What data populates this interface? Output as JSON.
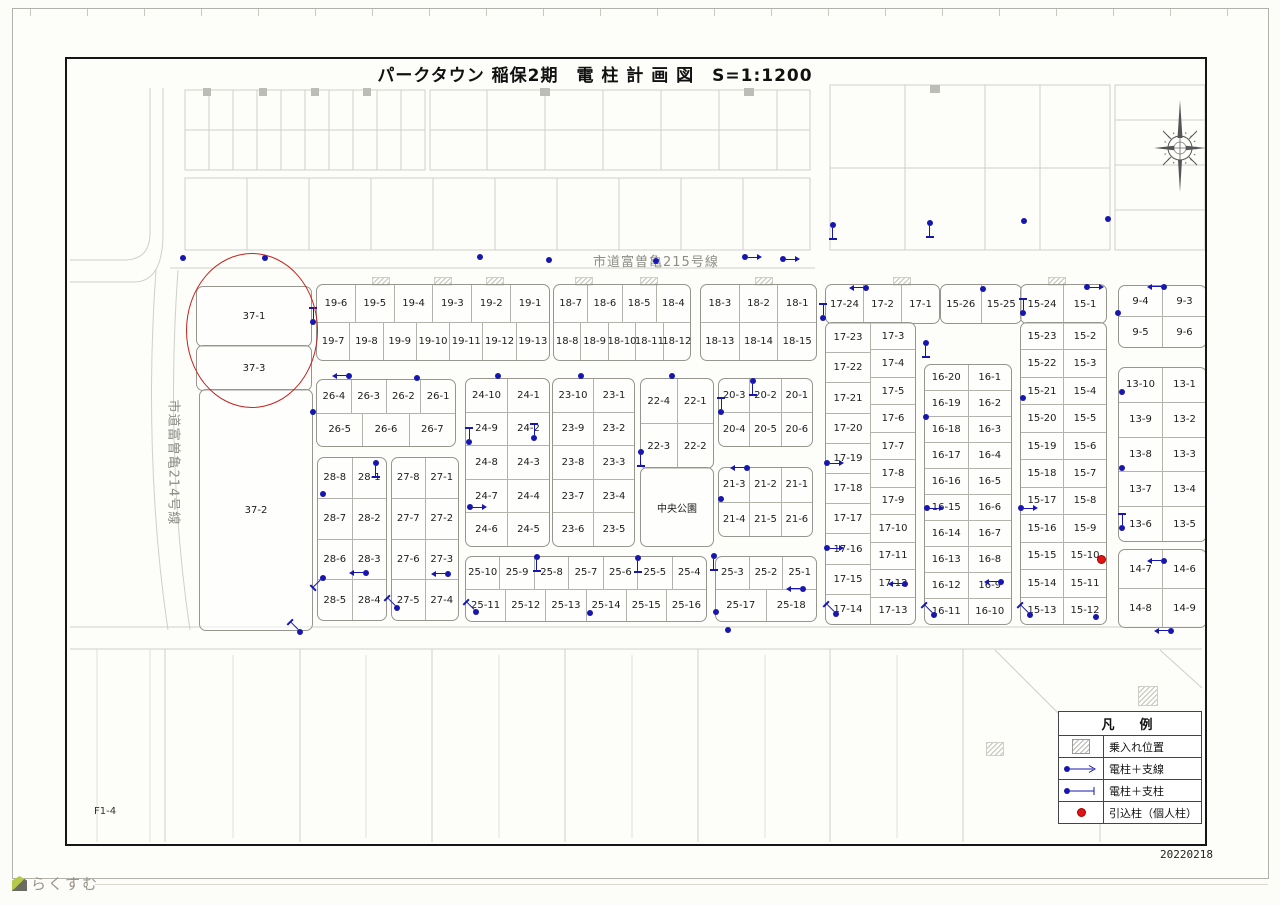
{
  "title": "パークタウン 稲保2期　電 柱 計 画 図　S=1:1200",
  "roads": {
    "r215": "市道富曽亀215号線",
    "r214": "市道富曽亀214号線"
  },
  "sheet_label": "F1-4",
  "date": "20220218",
  "watermark": "らくすむ",
  "legend": {
    "title": "凡　例",
    "items": [
      {
        "symbol": "hatch-square",
        "label": "乗入れ位置"
      },
      {
        "symbol": "pole-arrow",
        "label": "電柱＋支線"
      },
      {
        "symbol": "pole-strut",
        "label": "電柱＋支柱"
      },
      {
        "symbol": "red-dot",
        "label": "引込柱（個人柱）"
      }
    ]
  },
  "colors": {
    "pole_blue": "#1717b0",
    "accent_red": "#c5221c",
    "line_gray": "#cfcfca",
    "frame_black": "#151515"
  },
  "map": {
    "blocks": [
      {
        "id": "19",
        "kind": "rows",
        "x": 316,
        "y": 284,
        "w": 232,
        "h": 75,
        "rows": [
          [
            "19-6",
            "19-5",
            "19-4",
            "19-3",
            "19-2",
            "19-1"
          ],
          [
            "19-7",
            "19-8",
            "19-9",
            "19-10",
            "19-11",
            "19-12",
            "19-13"
          ]
        ]
      },
      {
        "id": "18L",
        "kind": "rows",
        "x": 553,
        "y": 284,
        "w": 136,
        "h": 75,
        "rows": [
          [
            "18-7",
            "18-6",
            "18-5",
            "18-4"
          ],
          [
            "18-8",
            "18-9",
            "18-10",
            "18-11",
            "18-12"
          ]
        ]
      },
      {
        "id": "18R",
        "kind": "rows",
        "x": 700,
        "y": 284,
        "w": 115,
        "h": 75,
        "rows": [
          [
            "18-3",
            "18-2",
            "18-1"
          ],
          [
            "18-13",
            "18-14",
            "18-15"
          ]
        ]
      },
      {
        "id": "17T",
        "kind": "rows",
        "x": 825,
        "y": 284,
        "w": 113,
        "h": 38,
        "rows": [
          [
            "17-24",
            "17-2",
            "17-1"
          ]
        ]
      },
      {
        "id": "15T1",
        "kind": "rows",
        "x": 940,
        "y": 284,
        "w": 80,
        "h": 38,
        "rows": [
          [
            "15-26",
            "15-25"
          ]
        ]
      },
      {
        "id": "15T2",
        "kind": "rows",
        "x": 1020,
        "y": 284,
        "w": 85,
        "h": 38,
        "rows": [
          [
            "15-24",
            "15-1"
          ]
        ]
      },
      {
        "id": "17C",
        "kind": "cols",
        "x": 825,
        "y": 322,
        "w": 89,
        "h": 301,
        "cols": [
          [
            "17-23",
            "17-22",
            "17-21",
            "17-20",
            "17-19",
            "17-18",
            "17-17",
            "17-16",
            "17-15",
            "17-14"
          ],
          [
            "17-3",
            "17-4",
            "17-5",
            "17-6",
            "17-7",
            "17-8",
            "17-9",
            "17-10",
            "17-11",
            "17-12",
            "17-13"
          ]
        ]
      },
      {
        "id": "16",
        "kind": "cols",
        "x": 924,
        "y": 364,
        "w": 86,
        "h": 259,
        "cols": [
          [
            "16-20",
            "16-19",
            "16-18",
            "16-17",
            "16-16",
            "16-15",
            "16-14",
            "16-13",
            "16-12",
            "16-11"
          ],
          [
            "16-1",
            "16-2",
            "16-3",
            "16-4",
            "16-5",
            "16-6",
            "16-7",
            "16-8",
            "16-9",
            "16-10"
          ]
        ]
      },
      {
        "id": "15C",
        "kind": "cols",
        "x": 1020,
        "y": 322,
        "w": 85,
        "h": 301,
        "cols": [
          [
            "15-23",
            "15-22",
            "15-21",
            "15-20",
            "15-19",
            "15-18",
            "15-17",
            "15-16",
            "15-15",
            "15-14",
            "15-13"
          ],
          [
            "15-2",
            "15-3",
            "15-4",
            "15-5",
            "15-6",
            "15-7",
            "15-8",
            "15-9",
            "15-10",
            "15-11",
            "15-12"
          ]
        ]
      },
      {
        "id": "9",
        "kind": "rows",
        "x": 1118,
        "y": 285,
        "w": 87,
        "h": 61,
        "rows": [
          [
            "9-4",
            "9-3"
          ],
          [
            "9-5",
            "9-6"
          ]
        ]
      },
      {
        "id": "13",
        "kind": "cols",
        "x": 1118,
        "y": 367,
        "w": 87,
        "h": 173,
        "cols": [
          [
            "13-10",
            "13-9",
            "13-8",
            "13-7",
            "13-6"
          ],
          [
            "13-1",
            "13-2",
            "13-3",
            "13-4",
            "13-5"
          ]
        ]
      },
      {
        "id": "14",
        "kind": "rows",
        "x": 1118,
        "y": 549,
        "w": 87,
        "h": 77,
        "rows": [
          [
            "14-7",
            "14-6"
          ],
          [
            "14-8",
            "14-9"
          ]
        ]
      },
      {
        "id": "26",
        "kind": "rows",
        "x": 316,
        "y": 379,
        "w": 138,
        "h": 66,
        "rows": [
          [
            "26-4",
            "26-3",
            "26-2",
            "26-1"
          ],
          [
            "26-5",
            "26-6",
            "26-7"
          ]
        ]
      },
      {
        "id": "24",
        "kind": "cols",
        "x": 465,
        "y": 378,
        "w": 83,
        "h": 167,
        "cols": [
          [
            "24-10",
            "24-9",
            "24-8",
            "24-7",
            "24-6"
          ],
          [
            "24-1",
            "24-2",
            "24-3",
            "24-4",
            "24-5"
          ]
        ]
      },
      {
        "id": "23",
        "kind": "cols",
        "x": 552,
        "y": 378,
        "w": 81,
        "h": 167,
        "cols": [
          [
            "23-10",
            "23-9",
            "23-8",
            "23-7",
            "23-6"
          ],
          [
            "23-1",
            "23-2",
            "23-3",
            "23-4",
            "23-5"
          ]
        ]
      },
      {
        "id": "22",
        "kind": "rows",
        "x": 640,
        "y": 378,
        "w": 72,
        "h": 89,
        "rows": [
          [
            "22-4",
            "22-1"
          ],
          [
            "22-3",
            "22-2"
          ]
        ]
      },
      {
        "id": "park",
        "kind": "rows",
        "x": 640,
        "y": 467,
        "w": 72,
        "h": 78,
        "rows": [
          [
            "中央公園"
          ]
        ]
      },
      {
        "id": "20",
        "kind": "rows",
        "x": 718,
        "y": 378,
        "w": 93,
        "h": 67,
        "rows": [
          [
            "20-3",
            "20-2",
            "20-1"
          ],
          [
            "20-4",
            "20-5",
            "20-6"
          ]
        ]
      },
      {
        "id": "21",
        "kind": "rows",
        "x": 718,
        "y": 467,
        "w": 93,
        "h": 68,
        "rows": [
          [
            "21-3",
            "21-2",
            "21-1"
          ],
          [
            "21-4",
            "21-5",
            "21-6"
          ]
        ]
      },
      {
        "id": "28",
        "kind": "cols",
        "x": 317,
        "y": 457,
        "w": 68,
        "h": 162,
        "cols": [
          [
            "28-8",
            "28-7",
            "28-6",
            "28-5"
          ],
          [
            "28-1",
            "28-2",
            "28-3",
            "28-4"
          ]
        ]
      },
      {
        "id": "27",
        "kind": "cols",
        "x": 391,
        "y": 457,
        "w": 66,
        "h": 162,
        "cols": [
          [
            "27-8",
            "27-7",
            "27-6",
            "27-5"
          ],
          [
            "27-1",
            "27-2",
            "27-3",
            "27-4"
          ]
        ]
      },
      {
        "id": "25L",
        "kind": "rows",
        "x": 465,
        "y": 556,
        "w": 240,
        "h": 64,
        "rows": [
          [
            "25-10",
            "25-9",
            "25-8",
            "25-7",
            "25-6",
            "25-5",
            "25-4"
          ],
          [
            "25-11",
            "25-12",
            "25-13",
            "25-14",
            "25-15",
            "25-16"
          ]
        ]
      },
      {
        "id": "25R",
        "kind": "rows",
        "x": 715,
        "y": 556,
        "w": 100,
        "h": 64,
        "rows": [
          [
            "25-3",
            "25-2",
            "25-1"
          ],
          [
            "25-17",
            "25-18"
          ]
        ]
      },
      {
        "id": "37-1",
        "kind": "rows",
        "x": 196,
        "y": 286,
        "w": 114,
        "h": 59,
        "rows": [
          [
            "37-1"
          ]
        ]
      },
      {
        "id": "37-3",
        "kind": "rows",
        "x": 196,
        "y": 345,
        "w": 114,
        "h": 44,
        "rows": [
          [
            "37-3"
          ]
        ]
      },
      {
        "id": "37-2",
        "kind": "rows",
        "x": 199,
        "y": 389,
        "w": 112,
        "h": 240,
        "rows": [
          [
            "37-2"
          ]
        ]
      }
    ],
    "poles": [
      {
        "x": 183,
        "y": 258,
        "t": "dot"
      },
      {
        "x": 265,
        "y": 258,
        "t": "dot"
      },
      {
        "x": 313,
        "y": 322,
        "t": "strut",
        "r": -90
      },
      {
        "x": 480,
        "y": 257,
        "t": "dot"
      },
      {
        "x": 549,
        "y": 260,
        "t": "dot"
      },
      {
        "x": 656,
        "y": 261,
        "t": "dot"
      },
      {
        "x": 745,
        "y": 257,
        "t": "arrow",
        "r": 0
      },
      {
        "x": 783,
        "y": 259,
        "t": "arrow",
        "r": 0
      },
      {
        "x": 833,
        "y": 225,
        "t": "strut",
        "r": 90
      },
      {
        "x": 930,
        "y": 223,
        "t": "strut",
        "r": 90
      },
      {
        "x": 1024,
        "y": 221,
        "t": "dot"
      },
      {
        "x": 1108,
        "y": 219,
        "t": "dot"
      },
      {
        "x": 866,
        "y": 288,
        "t": "arrow",
        "r": 180
      },
      {
        "x": 983,
        "y": 289,
        "t": "dot"
      },
      {
        "x": 1087,
        "y": 287,
        "t": "arrow",
        "r": 0
      },
      {
        "x": 823,
        "y": 318,
        "t": "strut",
        "r": -90
      },
      {
        "x": 1023,
        "y": 313,
        "t": "strut",
        "r": -90
      },
      {
        "x": 926,
        "y": 343,
        "t": "strut",
        "r": 90
      },
      {
        "x": 349,
        "y": 376,
        "t": "arrow",
        "r": 180
      },
      {
        "x": 417,
        "y": 378,
        "t": "dot"
      },
      {
        "x": 498,
        "y": 376,
        "t": "dot"
      },
      {
        "x": 581,
        "y": 376,
        "t": "dot"
      },
      {
        "x": 672,
        "y": 376,
        "t": "dot"
      },
      {
        "x": 753,
        "y": 381,
        "t": "strut",
        "r": 90
      },
      {
        "x": 313,
        "y": 412,
        "t": "dot"
      },
      {
        "x": 721,
        "y": 412,
        "t": "strut",
        "r": -90
      },
      {
        "x": 926,
        "y": 417,
        "t": "dot"
      },
      {
        "x": 1023,
        "y": 398,
        "t": "dot"
      },
      {
        "x": 469,
        "y": 442,
        "t": "strut",
        "r": -90
      },
      {
        "x": 534,
        "y": 438,
        "t": "strut",
        "r": -90
      },
      {
        "x": 827,
        "y": 463,
        "t": "arrow",
        "r": 0
      },
      {
        "x": 641,
        "y": 452,
        "t": "strut",
        "r": 90
      },
      {
        "x": 747,
        "y": 468,
        "t": "arrow",
        "r": 180
      },
      {
        "x": 721,
        "y": 499,
        "t": "dot"
      },
      {
        "x": 470,
        "y": 507,
        "t": "arrow",
        "r": 0
      },
      {
        "x": 376,
        "y": 463,
        "t": "strut",
        "r": 90
      },
      {
        "x": 323,
        "y": 494,
        "t": "dot"
      },
      {
        "x": 827,
        "y": 548,
        "t": "arrow",
        "r": 0
      },
      {
        "x": 927,
        "y": 508,
        "t": "arrow",
        "r": 0
      },
      {
        "x": 1021,
        "y": 508,
        "t": "arrow",
        "r": 0
      },
      {
        "x": 366,
        "y": 573,
        "t": "arrow",
        "r": 180
      },
      {
        "x": 323,
        "y": 578,
        "t": "strut",
        "r": 135
      },
      {
        "x": 448,
        "y": 574,
        "t": "arrow",
        "r": 180
      },
      {
        "x": 397,
        "y": 608,
        "t": "strut",
        "r": -135
      },
      {
        "x": 537,
        "y": 557,
        "t": "strut",
        "r": 90
      },
      {
        "x": 638,
        "y": 558,
        "t": "strut",
        "r": 90
      },
      {
        "x": 714,
        "y": 556,
        "t": "strut",
        "r": 90
      },
      {
        "x": 803,
        "y": 589,
        "t": "arrow",
        "r": 180
      },
      {
        "x": 476,
        "y": 612,
        "t": "strut",
        "r": -135
      },
      {
        "x": 590,
        "y": 613,
        "t": "dot"
      },
      {
        "x": 716,
        "y": 612,
        "t": "dot"
      },
      {
        "x": 905,
        "y": 584,
        "t": "arrow",
        "r": 180
      },
      {
        "x": 1001,
        "y": 582,
        "t": "arrow",
        "r": 180
      },
      {
        "x": 836,
        "y": 614,
        "t": "strut",
        "r": -135
      },
      {
        "x": 934,
        "y": 615,
        "t": "strut",
        "r": -135
      },
      {
        "x": 1030,
        "y": 615,
        "t": "strut",
        "r": -135
      },
      {
        "x": 1096,
        "y": 617,
        "t": "dot"
      },
      {
        "x": 1164,
        "y": 287,
        "t": "arrow",
        "r": 180
      },
      {
        "x": 1118,
        "y": 313,
        "t": "dot"
      },
      {
        "x": 1122,
        "y": 392,
        "t": "dot"
      },
      {
        "x": 1122,
        "y": 468,
        "t": "dot"
      },
      {
        "x": 1122,
        "y": 528,
        "t": "strut",
        "r": -90
      },
      {
        "x": 1164,
        "y": 561,
        "t": "arrow",
        "r": 180
      },
      {
        "x": 1171,
        "y": 631,
        "t": "arrow",
        "r": 180
      },
      {
        "x": 300,
        "y": 632,
        "t": "strut",
        "r": -135
      },
      {
        "x": 728,
        "y": 630,
        "t": "dot"
      }
    ],
    "service_poles": [
      {
        "x": 1100,
        "y": 558
      }
    ],
    "hatches": [
      [
        372,
        277,
        16,
        7
      ],
      [
        434,
        277,
        16,
        7
      ],
      [
        486,
        277,
        16,
        7
      ],
      [
        575,
        277,
        16,
        7
      ],
      [
        640,
        277,
        16,
        7
      ],
      [
        755,
        277,
        16,
        7
      ],
      [
        893,
        277,
        16,
        7
      ],
      [
        1048,
        277,
        16,
        7
      ],
      [
        1138,
        686,
        18,
        18
      ],
      [
        986,
        742,
        16,
        12
      ]
    ]
  }
}
